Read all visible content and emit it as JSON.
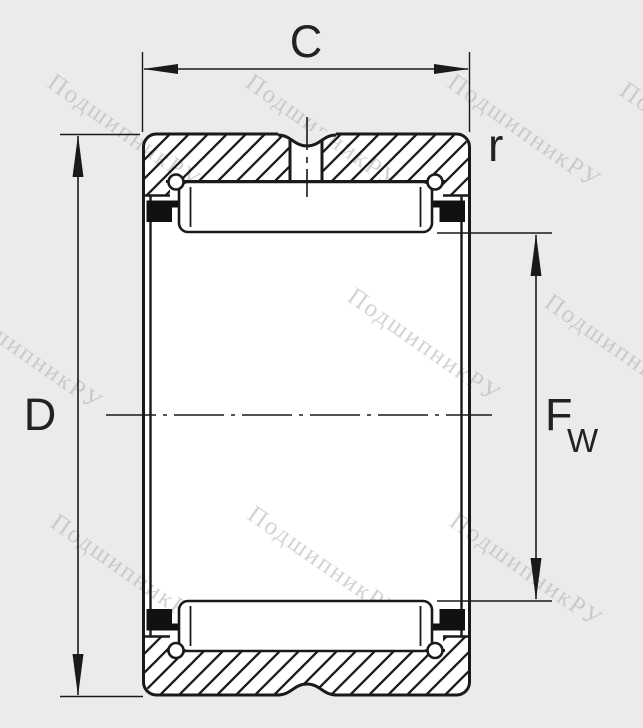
{
  "drawing": {
    "labels": {
      "c": "C",
      "d": "D",
      "r": "r",
      "fw_main": "F",
      "fw_sub": "W"
    },
    "watermark": {
      "text": "ПодшипникРУ",
      "color": "#b0b0b0"
    },
    "colors": {
      "background": "#ebebeb",
      "bore": "#ffffff",
      "line": "#1a1a1a",
      "seal": "#111111",
      "dimension_text": "#222222"
    }
  }
}
